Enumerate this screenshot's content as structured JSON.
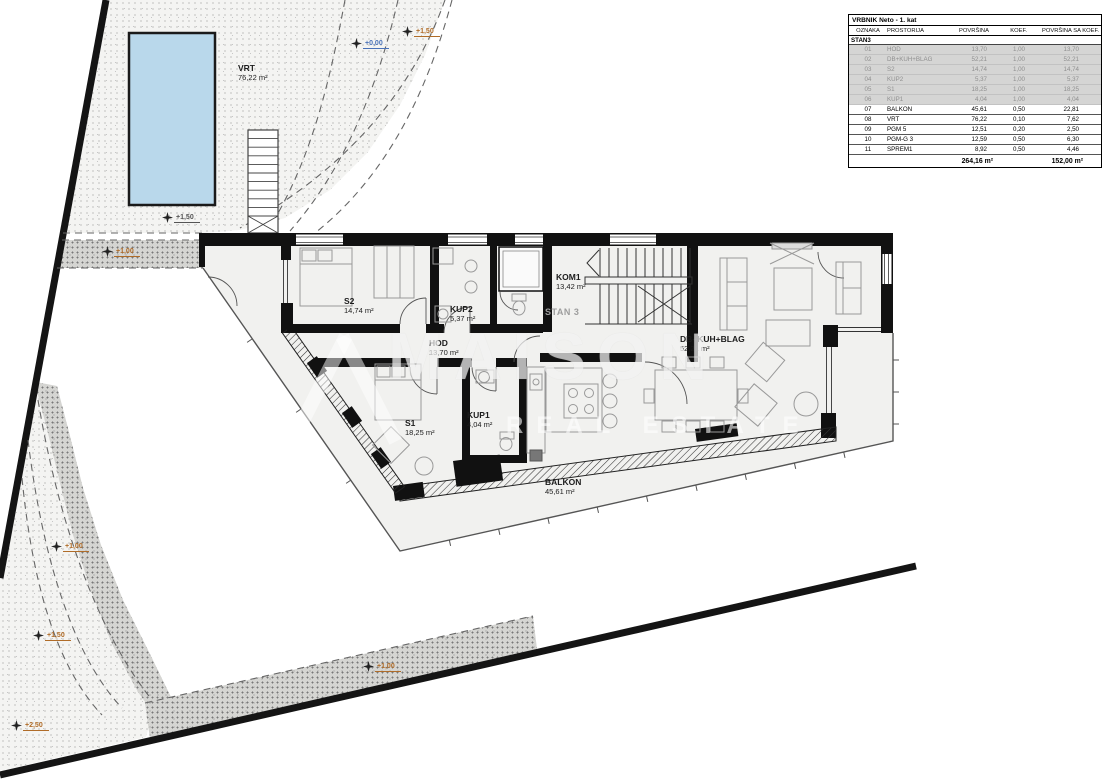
{
  "table": {
    "title": "VRBNIK Neto - 1. kat",
    "columns": [
      "OZNAKA",
      "PROSTORIJA",
      "POVRŠINA",
      "KOEF.",
      "POVRŠINA SA KOEF."
    ],
    "section": "STAN3",
    "rows": [
      {
        "id": "01",
        "name": "HOD",
        "area": "13,70",
        "koef": "1,00",
        "area_koef": "13,70",
        "muted": true
      },
      {
        "id": "02",
        "name": "DB+KUH+BLAG",
        "area": "52,21",
        "koef": "1,00",
        "area_koef": "52,21",
        "muted": true
      },
      {
        "id": "03",
        "name": "S2",
        "area": "14,74",
        "koef": "1,00",
        "area_koef": "14,74",
        "muted": true
      },
      {
        "id": "04",
        "name": "KUP2",
        "area": "5,37",
        "koef": "1,00",
        "area_koef": "5,37",
        "muted": true
      },
      {
        "id": "05",
        "name": "S1",
        "area": "18,25",
        "koef": "1,00",
        "area_koef": "18,25",
        "muted": true
      },
      {
        "id": "06",
        "name": "KUP1",
        "area": "4,04",
        "koef": "1,00",
        "area_koef": "4,04",
        "muted": true
      },
      {
        "id": "07",
        "name": "BALKON",
        "area": "45,61",
        "koef": "0,50",
        "area_koef": "22,81",
        "muted": false
      },
      {
        "id": "08",
        "name": "VRT",
        "area": "76,22",
        "koef": "0,10",
        "area_koef": "7,62",
        "muted": false
      },
      {
        "id": "09",
        "name": "PGM 5",
        "area": "12,51",
        "koef": "0,20",
        "area_koef": "2,50",
        "muted": false
      },
      {
        "id": "10",
        "name": "PGM-G 3",
        "area": "12,59",
        "koef": "0,50",
        "area_koef": "6,30",
        "muted": false
      },
      {
        "id": "11",
        "name": "SPREM1",
        "area": "8,92",
        "koef": "0,50",
        "area_koef": "4,46",
        "muted": false
      }
    ],
    "total_area": "264,16 m²",
    "total_area_koef": "152,00 m²"
  },
  "unit_label": "STAN 3",
  "rooms": {
    "vrt": {
      "name": "VRT",
      "area": "76,22 m²"
    },
    "s2": {
      "name": "S2",
      "area": "14,74 m²"
    },
    "kup2": {
      "name": "KUP2",
      "area": "5,37 m²"
    },
    "kom1": {
      "name": "KOM1",
      "area": "13,42 m²"
    },
    "hod": {
      "name": "HOD",
      "area": "13,70 m²"
    },
    "s1": {
      "name": "S1",
      "area": "18,25 m²"
    },
    "kup1": {
      "name": "KUP1",
      "area": "4,04 m²"
    },
    "living": {
      "name": "DB+KUH+BLAG",
      "area": "52,21 m²"
    },
    "balkon": {
      "name": "BALKON",
      "area": "45,61 m²"
    }
  },
  "markers": [
    {
      "label": "+0,00",
      "x": 356,
      "y": 44,
      "color": "#4a72b8"
    },
    {
      "label": "+1,50",
      "x": 407,
      "y": 32,
      "color": "#b06c28"
    },
    {
      "label": "+1,50",
      "x": 167,
      "y": 218,
      "color": "#555555"
    },
    {
      "label": "+1,00",
      "x": 107,
      "y": 252,
      "color": "#b06c28"
    },
    {
      "label": "+1,00",
      "x": 56,
      "y": 547,
      "color": "#b06c28"
    },
    {
      "label": "+1,50",
      "x": 38,
      "y": 636,
      "color": "#b06c28"
    },
    {
      "label": "+2,50",
      "x": 16,
      "y": 726,
      "color": "#b06c28"
    },
    {
      "label": "+1,00",
      "x": 368,
      "y": 667,
      "color": "#b06c28"
    }
  ],
  "watermark": {
    "line1": "MAISON",
    "line2": "REAL ESTATE"
  },
  "colors": {
    "pool": "#b9d8eb",
    "marker_orange": "#b06c28",
    "marker_blue": "#4a72b8",
    "muted_row_bg": "#d5d5d4"
  }
}
